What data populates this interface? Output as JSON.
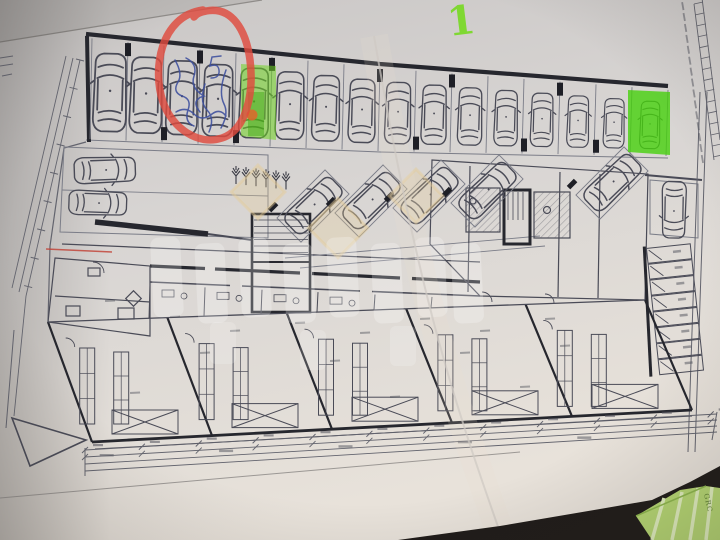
{
  "scene": {
    "description": "Photograph of a printed architectural ground-floor parking plan lying on a dark table, annotated with marker highlights, a red circle and blue pen notes",
    "green_numeral": "1",
    "green_object_label": "GRC"
  },
  "paper": {
    "color": "#d8d5d3",
    "shadow_color": "#bdbab8",
    "table_color": "#201c19"
  },
  "ink": {
    "line_color": "#4a4b57",
    "wall_color": "#26272e",
    "dim_color": "#63646e"
  },
  "plan": {
    "top_parking_row": {
      "stall_count": 16,
      "car_count": 16
    },
    "left_parking": {
      "car_count": 2
    },
    "angled_parking": {
      "car_count": 5
    },
    "right_parking": {
      "car_count": 1,
      "storage_cell_count": 8
    },
    "tree_count": 6
  },
  "annotations": {
    "red_circle": {
      "color": "#df4b3e",
      "circled_stalls": 2
    },
    "blue_pen": {
      "color": "#3d4f9e"
    },
    "green_marker": {
      "highlighted_stall_left": "#6fd322",
      "highlighted_stall_right": "#46d10c",
      "numeral_color": "#79d926"
    },
    "orange_dot": {
      "color": "#e0662c"
    },
    "red_line": {
      "color": "#c23f33"
    }
  },
  "watermark": {
    "diamond_color": "#e6cc96",
    "letter_color": "#ffffff"
  }
}
